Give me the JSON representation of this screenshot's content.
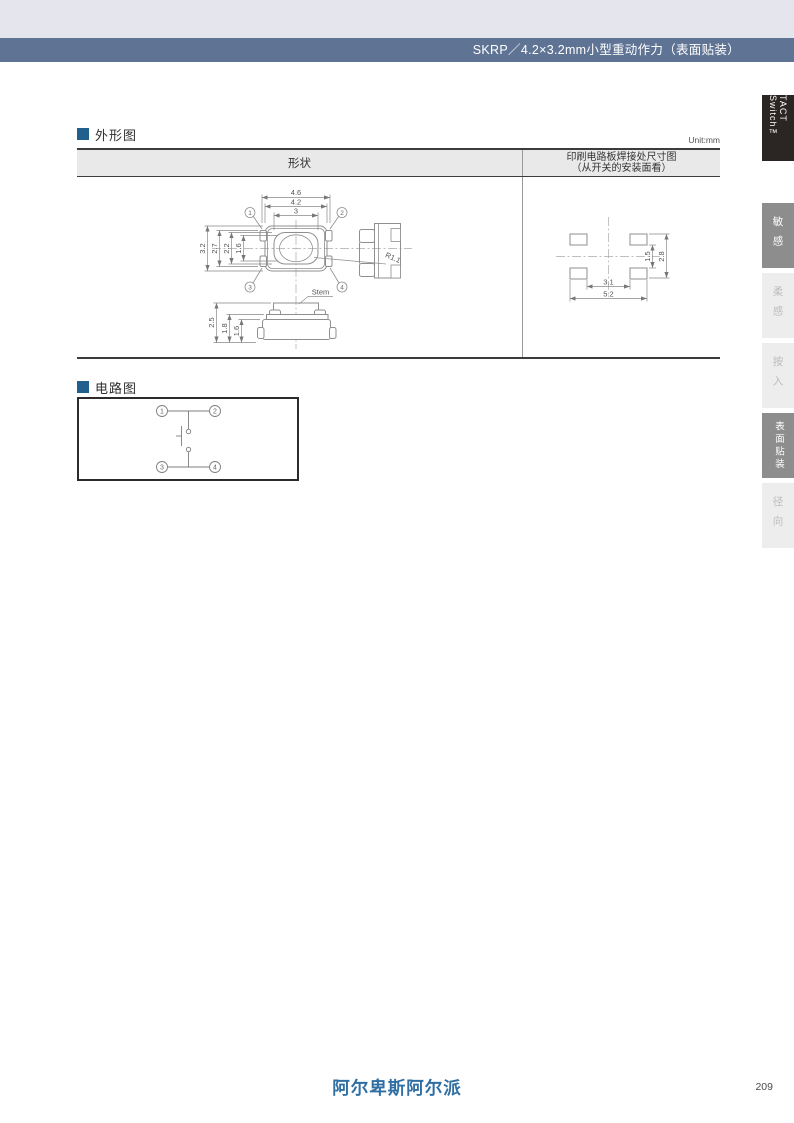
{
  "header": {
    "title": "SKRP／4.2×3.2mm小型重动作力（表面贴装）"
  },
  "side_tabs": {
    "product": "TACT Switch™",
    "items": [
      {
        "label": "敏感",
        "active": true
      },
      {
        "label": "柔感",
        "active": false
      },
      {
        "label": "按入",
        "active": false
      },
      {
        "label": "表面贴装",
        "active": true
      },
      {
        "label": "径向",
        "active": false
      }
    ]
  },
  "outline_section": {
    "title": "外形图",
    "unit": "Unit:mm",
    "table": {
      "col1_header": "形状",
      "col2_header_line1": "印刷电路板焊接处尺寸图",
      "col2_header_line2": "（从开关的安装面看）"
    },
    "drawing": {
      "top_view": {
        "dim_w_outer": "4.6",
        "dim_w_body": "4.2",
        "dim_w_stem": "3",
        "dim_h_body": "3.2",
        "dim_h_27": "2.7",
        "dim_h_stem": "2.2",
        "dim_h_16": "1.6",
        "radius_label": "R1.1",
        "terminal_1": "1",
        "terminal_2": "2",
        "terminal_3": "3",
        "terminal_4": "4"
      },
      "front_view": {
        "dim_h_total": "2.5",
        "dim_h_18": "1.8",
        "dim_h_16": "1.6",
        "stem_label": "Stem"
      },
      "pcb_pattern": {
        "dim_w_inner": "3.1",
        "dim_w_outer": "5.2",
        "dim_h_inner": "1.5",
        "dim_h_outer": "2.8"
      }
    }
  },
  "circuit_section": {
    "title": "电路图",
    "terminal_1": "1",
    "terminal_2": "2",
    "terminal_3": "3",
    "terminal_4": "4"
  },
  "footer": {
    "logo": "阿尔卑斯阿尔派",
    "page": "209"
  }
}
